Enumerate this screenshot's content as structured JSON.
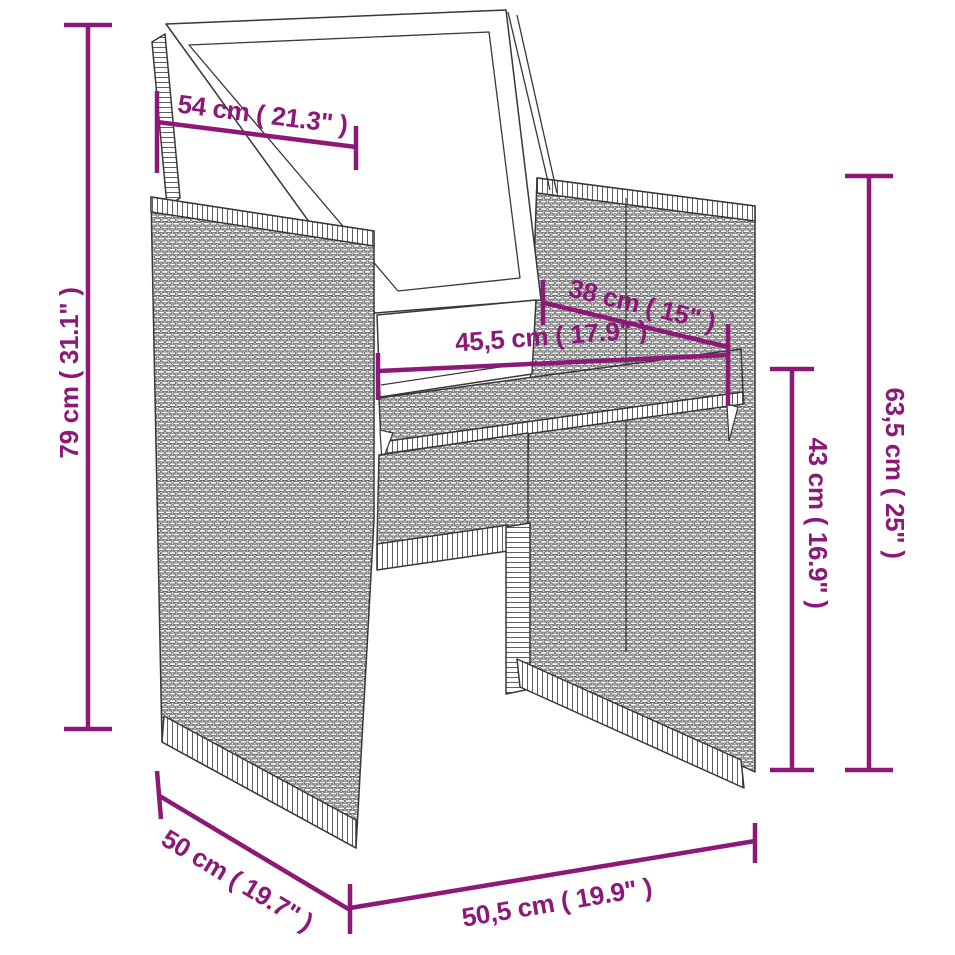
{
  "diagram": {
    "background": "#ffffff",
    "accent_color": "#8C1878",
    "outline_color": "#383838",
    "subject": "poly-rattan-armchair-with-cushions",
    "dimensions": {
      "top_width": "54 cm ( 21.3\" )",
      "total_height": "79 cm ( 31.1\" )",
      "seat_depth": "38 cm ( 15\" )",
      "seat_width": "45,5 cm ( 17.9\" )",
      "back_height": "63,5 cm ( 25\" )",
      "seat_height": "43 cm ( 16.9\" )",
      "base_depth": "50 cm ( 19.7\" )",
      "base_width": "50,5 cm ( 19.9\" )"
    }
  }
}
